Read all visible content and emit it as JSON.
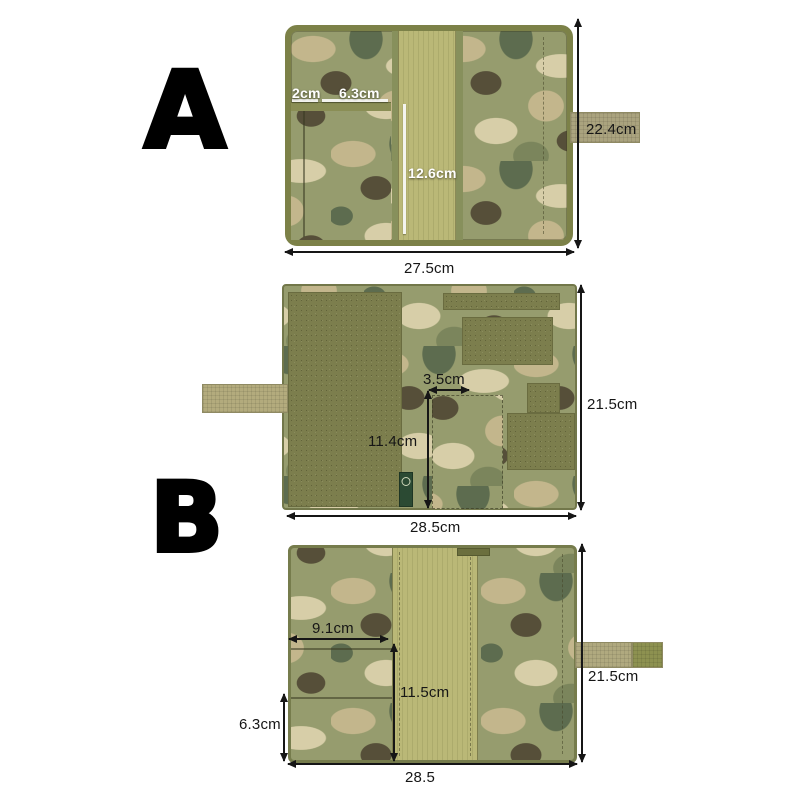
{
  "labels": {
    "a": "A",
    "b": "B"
  },
  "product_a": {
    "pen_slot_width": "2cm",
    "card_pocket_width": "6.3cm",
    "elastic_band_length": "12.6cm",
    "cover_height": "22.4cm",
    "cover_width": "27.5cm"
  },
  "product_b_exterior": {
    "patch_pocket_width": "3.5cm",
    "patch_pocket_height": "11.4cm",
    "panel_height": "21.5cm",
    "panel_width": "28.5cm"
  },
  "product_b_interior": {
    "pocket_width": "9.1cm",
    "center_panel_length": "11.5cm",
    "lower_pocket_height": "6.3cm",
    "cover_height": "21.5cm",
    "cover_width": "28.5"
  },
  "colors": {
    "annotation_dark": "#161616",
    "annotation_light": "#ffffff",
    "camo_palette": [
      "#969c6e",
      "#c3b68c",
      "#d7cea8",
      "#564f39",
      "#5d6c4f"
    ],
    "velcro_olive": "#7c7e4d",
    "panel_khaki": "#bab877",
    "strap_tan": "#aaa37e",
    "binding_olive": "#7c8148",
    "tag_green": "#2b4a33",
    "background": "#ffffff"
  }
}
